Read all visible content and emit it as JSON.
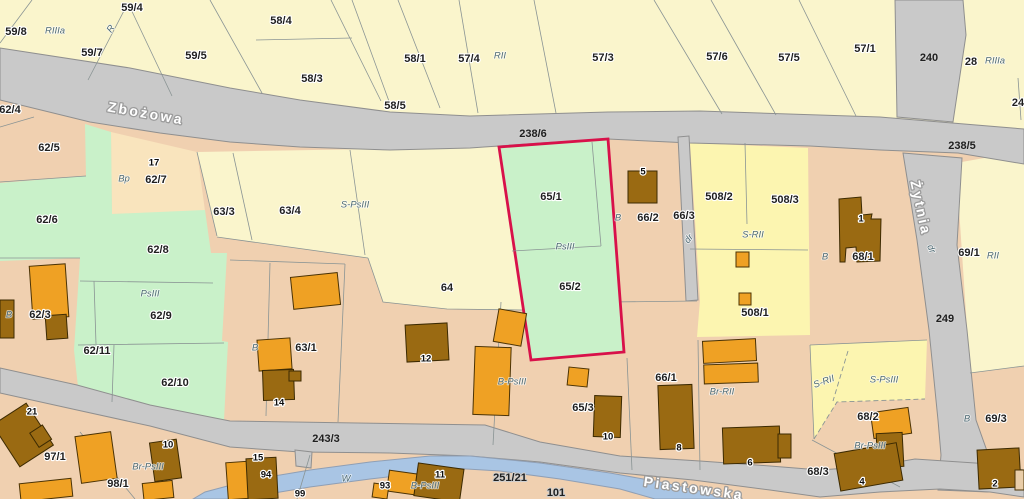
{
  "title": "Mapa ewidencyjna działek (cadastral parcel map)",
  "highlighted_parcel": {
    "numbers": [
      "65/1",
      "65/2"
    ],
    "outline_color": "#d8114a",
    "soil_class": "PsIII"
  },
  "colors": {
    "parcel_tan": "#f0d0b0",
    "parcel_yellow_pale": "#faf5cc",
    "parcel_yellow_bright": "#fcf5b0",
    "parcel_green": "#c9f1c9",
    "parcel_peach": "#f9e4bd",
    "road_gray": "#c9c9c9",
    "water_blue": "#a9c5e4",
    "building_orange": "#efa124",
    "building_brown": "#9a6a12",
    "highlight_red": "#d8114a"
  },
  "streets": [
    {
      "name": "Zbożowa",
      "x": 146,
      "y": 113,
      "rot": 10
    },
    {
      "name": "Piastowska",
      "x": 694,
      "y": 488,
      "rot": 8
    },
    {
      "name": "Żytnia",
      "x": 921,
      "y": 208,
      "rot": 78
    }
  ],
  "parcel_labels": [
    {
      "t": "59/8",
      "x": 16,
      "y": 32
    },
    {
      "t": "59/4",
      "x": 132,
      "y": 8
    },
    {
      "t": "59/7",
      "x": 92,
      "y": 53
    },
    {
      "t": "59/5",
      "x": 196,
      "y": 56
    },
    {
      "t": "58/4",
      "x": 281,
      "y": 21
    },
    {
      "t": "58/3",
      "x": 312,
      "y": 79
    },
    {
      "t": "58/5",
      "x": 395,
      "y": 106
    },
    {
      "t": "58/1",
      "x": 415,
      "y": 59
    },
    {
      "t": "57/4",
      "x": 469,
      "y": 59
    },
    {
      "t": "57/3",
      "x": 603,
      "y": 58
    },
    {
      "t": "57/6",
      "x": 717,
      "y": 57
    },
    {
      "t": "57/5",
      "x": 789,
      "y": 58
    },
    {
      "t": "57/1",
      "x": 865,
      "y": 49
    },
    {
      "t": "28",
      "x": 971,
      "y": 62
    },
    {
      "t": "24",
      "x": 1018,
      "y": 103
    },
    {
      "t": "62/4",
      "x": 10,
      "y": 110
    },
    {
      "t": "62/5",
      "x": 49,
      "y": 148
    },
    {
      "t": "62/7",
      "x": 156,
      "y": 180
    },
    {
      "t": "62/6",
      "x": 47,
      "y": 220
    },
    {
      "t": "62/8",
      "x": 158,
      "y": 250
    },
    {
      "t": "62/9",
      "x": 161,
      "y": 316
    },
    {
      "t": "62/3",
      "x": 40,
      "y": 315
    },
    {
      "t": "62/11",
      "x": 97,
      "y": 351
    },
    {
      "t": "62/10",
      "x": 175,
      "y": 383
    },
    {
      "t": "63/3",
      "x": 224,
      "y": 212
    },
    {
      "t": "63/4",
      "x": 290,
      "y": 211
    },
    {
      "t": "64",
      "x": 447,
      "y": 288
    },
    {
      "t": "63/1",
      "x": 306,
      "y": 348
    },
    {
      "t": "65/1",
      "x": 551,
      "y": 197
    },
    {
      "t": "65/2",
      "x": 570,
      "y": 287
    },
    {
      "t": "66/2",
      "x": 648,
      "y": 218
    },
    {
      "t": "66/3",
      "x": 684,
      "y": 216
    },
    {
      "t": "508/2",
      "x": 719,
      "y": 197
    },
    {
      "t": "508/3",
      "x": 785,
      "y": 200
    },
    {
      "t": "508/1",
      "x": 755,
      "y": 313
    },
    {
      "t": "68/1",
      "x": 863,
      "y": 257
    },
    {
      "t": "69/1",
      "x": 969,
      "y": 253
    },
    {
      "t": "65/3",
      "x": 583,
      "y": 408
    },
    {
      "t": "66/1",
      "x": 666,
      "y": 378
    },
    {
      "t": "68/2",
      "x": 868,
      "y": 417
    },
    {
      "t": "68/3",
      "x": 818,
      "y": 472
    },
    {
      "t": "69/3",
      "x": 996,
      "y": 419
    },
    {
      "t": "97/1",
      "x": 55,
      "y": 457
    },
    {
      "t": "98/1",
      "x": 118,
      "y": 484
    }
  ],
  "road_labels": [
    {
      "t": "238/6",
      "x": 533,
      "y": 134
    },
    {
      "t": "238/5",
      "x": 962,
      "y": 146
    },
    {
      "t": "240",
      "x": 929,
      "y": 58
    },
    {
      "t": "249",
      "x": 945,
      "y": 319
    },
    {
      "t": "243/3",
      "x": 326,
      "y": 439
    },
    {
      "t": "251/21",
      "x": 510,
      "y": 478
    },
    {
      "t": "101",
      "x": 556,
      "y": 493
    }
  ],
  "soil_labels": [
    {
      "t": "RIIIa",
      "x": 55,
      "y": 31
    },
    {
      "t": "R",
      "x": 111,
      "y": 29,
      "rot": -55
    },
    {
      "t": "RII",
      "x": 500,
      "y": 56
    },
    {
      "t": "RIIIa",
      "x": 995,
      "y": 61
    },
    {
      "t": "Bp",
      "x": 124,
      "y": 179
    },
    {
      "t": "S-PsIII",
      "x": 355,
      "y": 205
    },
    {
      "t": "PsIII",
      "x": 150,
      "y": 294
    },
    {
      "t": "B",
      "x": 9,
      "y": 315
    },
    {
      "t": "B",
      "x": 255,
      "y": 348
    },
    {
      "t": "PsIII",
      "x": 565,
      "y": 247
    },
    {
      "t": "B",
      "x": 618,
      "y": 218
    },
    {
      "t": "dr",
      "x": 689,
      "y": 239,
      "rot": -50
    },
    {
      "t": "S-RII",
      "x": 753,
      "y": 235
    },
    {
      "t": "B",
      "x": 825,
      "y": 257
    },
    {
      "t": "RII",
      "x": 993,
      "y": 256
    },
    {
      "t": "dr",
      "x": 931,
      "y": 249,
      "rot": 65
    },
    {
      "t": "B-PsIII",
      "x": 512,
      "y": 382
    },
    {
      "t": "Br-PsIII",
      "x": 148,
      "y": 467
    },
    {
      "t": "W",
      "x": 346,
      "y": 479
    },
    {
      "t": "B-PsIII",
      "x": 425,
      "y": 486
    },
    {
      "t": "Br-RII",
      "x": 722,
      "y": 392
    },
    {
      "t": "S-RII",
      "x": 824,
      "y": 382,
      "rot": -20
    },
    {
      "t": "S-PsIII",
      "x": 884,
      "y": 380
    },
    {
      "t": "Br-PsIII",
      "x": 870,
      "y": 446
    },
    {
      "t": "B",
      "x": 967,
      "y": 419
    }
  ],
  "building_labels": [
    {
      "t": "17",
      "x": 154,
      "y": 163
    },
    {
      "t": "21",
      "x": 32,
      "y": 412
    },
    {
      "t": "5",
      "x": 643,
      "y": 172
    },
    {
      "t": "1",
      "x": 861,
      "y": 219
    },
    {
      "t": "12",
      "x": 426,
      "y": 359
    },
    {
      "t": "10",
      "x": 608,
      "y": 437
    },
    {
      "t": "14",
      "x": 279,
      "y": 403
    },
    {
      "t": "15",
      "x": 258,
      "y": 458
    },
    {
      "t": "94",
      "x": 266,
      "y": 475
    },
    {
      "t": "99",
      "x": 300,
      "y": 494
    },
    {
      "t": "93",
      "x": 385,
      "y": 486
    },
    {
      "t": "11",
      "x": 440,
      "y": 475
    },
    {
      "t": "10",
      "x": 168,
      "y": 445
    },
    {
      "t": "8",
      "x": 679,
      "y": 448
    },
    {
      "t": "6",
      "x": 750,
      "y": 463
    },
    {
      "t": "4",
      "x": 862,
      "y": 482
    },
    {
      "t": "2",
      "x": 995,
      "y": 484
    }
  ]
}
